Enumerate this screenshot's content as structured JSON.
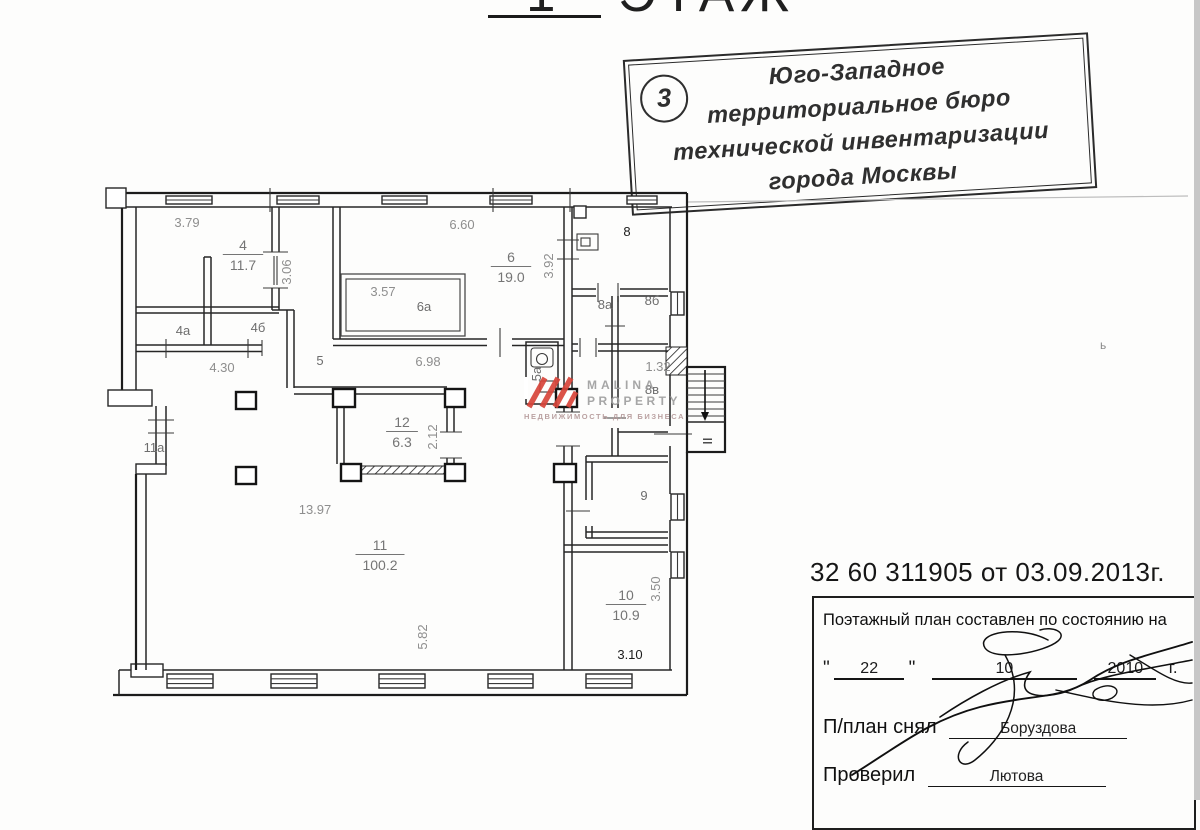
{
  "page": {
    "floor_title": {
      "number": "1",
      "word": "ЭТАЖ"
    },
    "doc_number": "32 60 311905 от 03.09.2013г.",
    "scan_artifact": "ь"
  },
  "stamp": {
    "badge_number": "3",
    "lines": [
      "Юго-Западное",
      "территориальное бюро",
      "технической инвентаризации",
      "города Москвы"
    ]
  },
  "watermark": {
    "line1": "MALINA",
    "line2": "PROPERTY",
    "tagline": "НЕДВИЖИМОСТЬ ДЛЯ БИЗНЕСА",
    "accent_color": "#d8453a",
    "text_color": "#9f9f9f"
  },
  "footer_box": {
    "statement": "Поэтажный план составлен по состоянию на",
    "open_quote": "\"",
    "day": "22",
    "close_quote": "\"",
    "month": "10",
    "year": "2010",
    "year_suffix": "г.",
    "surveyor_label": "П/план снял",
    "surveyor_name": "Боруздова",
    "checker_label": "Проверил",
    "checker_name": "Лютова"
  },
  "plan": {
    "rooms": [
      {
        "num": "4",
        "area": "11.7",
        "x": 243,
        "y": 250
      },
      {
        "num": "6",
        "area": "19.0",
        "x": 511,
        "y": 262
      },
      {
        "num": "12",
        "area": "6.3",
        "x": 402,
        "y": 427
      },
      {
        "num": "11",
        "area": "100.2",
        "x": 380,
        "y": 550
      },
      {
        "num": "10",
        "area": "10.9",
        "x": 626,
        "y": 600
      }
    ],
    "labels": [
      {
        "text": "3.79",
        "x": 187,
        "y": 227,
        "cls": "dim"
      },
      {
        "text": "3.06",
        "x": 291,
        "y": 272,
        "rot": -90,
        "cls": "dim"
      },
      {
        "text": "4.30",
        "x": 222,
        "y": 372,
        "cls": "dim"
      },
      {
        "text": "6.60",
        "x": 462,
        "y": 229,
        "cls": "dim"
      },
      {
        "text": "3.92",
        "x": 553,
        "y": 266,
        "rot": -90,
        "cls": "dim"
      },
      {
        "text": "3.57",
        "x": 383,
        "y": 296,
        "cls": "dim"
      },
      {
        "text": "6.98",
        "x": 428,
        "y": 366,
        "cls": "dim"
      },
      {
        "text": "2.12",
        "x": 437,
        "y": 437,
        "rot": -90,
        "cls": "dim"
      },
      {
        "text": "13.97",
        "x": 315,
        "y": 514,
        "cls": "dim"
      },
      {
        "text": "5.82",
        "x": 427,
        "y": 637,
        "rot": -90,
        "cls": "dim"
      },
      {
        "text": "3.50",
        "x": 660,
        "y": 589,
        "rot": -90,
        "cls": "dim"
      },
      {
        "text": "1.32",
        "x": 658,
        "y": 371,
        "cls": "dim"
      },
      {
        "text": "3.10",
        "x": 630,
        "y": 659,
        "cls": "dark",
        "size": 16
      },
      {
        "text": "4а",
        "x": 183,
        "y": 335,
        "cls": "room"
      },
      {
        "text": "4б",
        "x": 258,
        "y": 332,
        "cls": "room"
      },
      {
        "text": "5",
        "x": 320,
        "y": 365,
        "cls": "room",
        "size": 15
      },
      {
        "text": "6а",
        "x": 424,
        "y": 311,
        "cls": "room",
        "size": 15
      },
      {
        "text": "5а",
        "x": 541,
        "y": 374,
        "rot": -90,
        "cls": "room",
        "size": 10
      },
      {
        "text": "8",
        "x": 627,
        "y": 236,
        "cls": "dark",
        "size": 17
      },
      {
        "text": "8а",
        "x": 605,
        "y": 309,
        "cls": "room",
        "size": 14
      },
      {
        "text": "8б",
        "x": 652,
        "y": 305,
        "cls": "room",
        "size": 14
      },
      {
        "text": "8в",
        "x": 652,
        "y": 394,
        "cls": "room"
      },
      {
        "text": "9",
        "x": 644,
        "y": 500,
        "cls": "room",
        "size": 16
      },
      {
        "text": "11а",
        "x": 154,
        "y": 452,
        "cls": "room"
      },
      {
        "text": "II",
        "x": 712,
        "y": 441,
        "rot": -90,
        "cls": "dark",
        "size": 14
      }
    ]
  }
}
